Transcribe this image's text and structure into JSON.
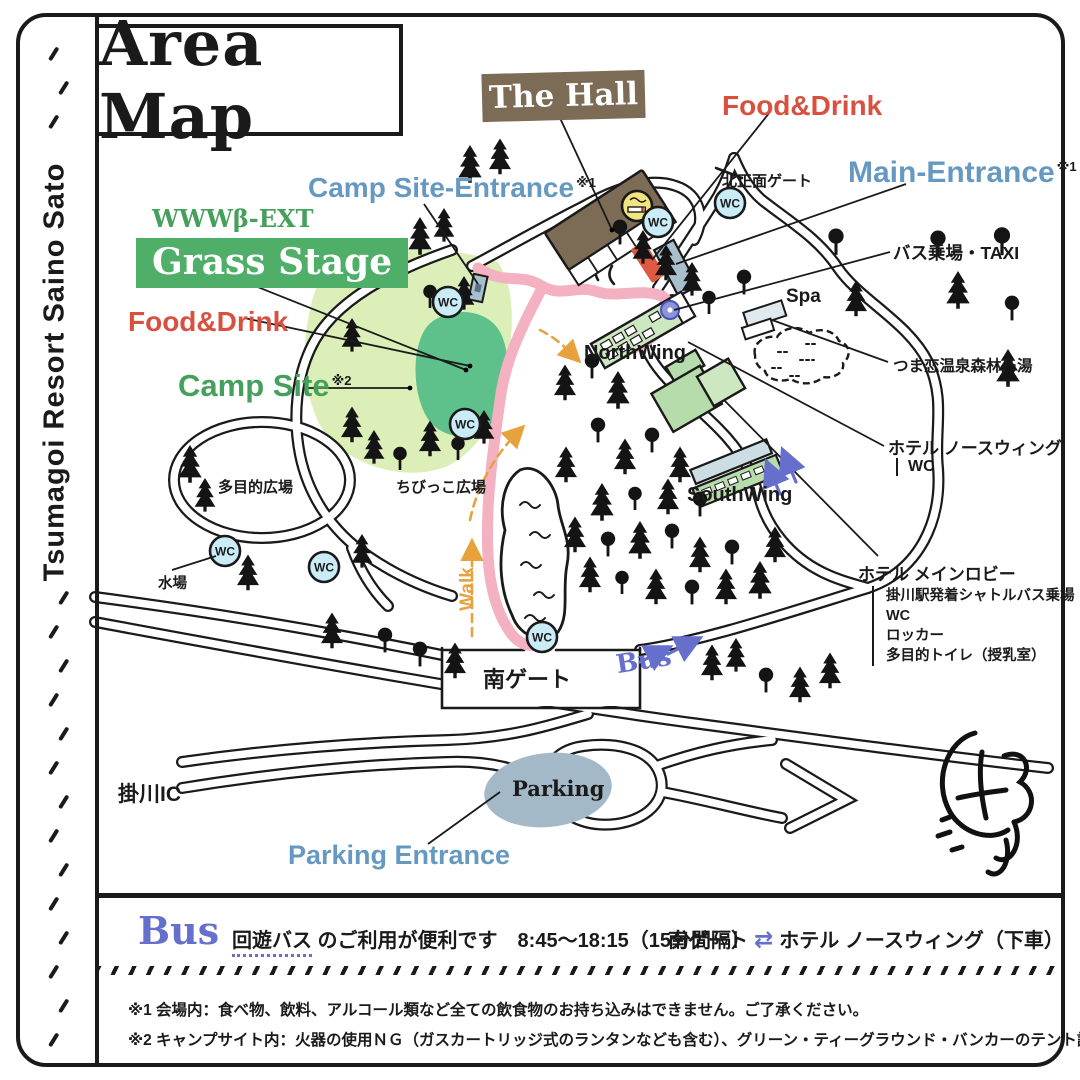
{
  "header": {
    "title": "Area Map",
    "side_label": "Tsumagoi Resort Saino Sato"
  },
  "map_labels": {
    "the_hall": "The Hall",
    "food_drink_top": "Food&Drink",
    "main_entrance": "Main-Entrance",
    "main_entrance_note": "※1",
    "north_gate": "北正面ゲート",
    "bus_taxi": "バス乗場・TAXI",
    "camp_site_entrance": "Camp Site-Entrance",
    "camp_site_entrance_note": "※1",
    "stage_brand": "WWWβ-EXT",
    "grass_stage": "Grass Stage",
    "food_drink_left": "Food&Drink",
    "camp_site": "Camp Site",
    "camp_site_note": "※2",
    "spa": "Spa",
    "onsen": "つま恋温泉森林乃湯",
    "north_wing": "NorthWing",
    "south_wing": "SouthWing",
    "hotel_north_wing": "ホテル ノースウィング",
    "hotel_north_wing_sub": "WC",
    "lobby_title": "ホテル メインロビー",
    "lobby_items": [
      "掛川駅発着シャトルバス乗場",
      "WC",
      "ロッカー",
      "多目的トイレ（授乳室）"
    ],
    "multipurpose_plaza": "多目的広場",
    "kids_plaza": "ちびっこ広場",
    "water_station": "水場",
    "south_gate": "南ゲート",
    "walk": "Walk",
    "bus": "Bus",
    "kakegawa_ic": "掛川IC",
    "parking": "Parking",
    "parking_entrance": "Parking Entrance",
    "wc": "WC"
  },
  "bus_info": {
    "heading": "Bus",
    "service": "回遊バス",
    "service_rest": " のご利用が便利です",
    "hours": "　8:45～18:15（15分間隔）",
    "route_from": "南ゲート",
    "route_arrows": "⇄",
    "route_to": "ホテル ノースウィング（下車）"
  },
  "notes": [
    "※1 会場内：食べ物、飲料、アルコール類など全ての飲食物のお持ち込みはできません。ご了承ください。",
    "※2 キャンプサイト内：火器の使用ＮＧ（ガスカートリッジ式のランタンなども含む）、グリーン・ティーグラウンド・バンカーのテント設営はできません"
  ],
  "colors": {
    "ink": "#1a1a1a",
    "red": "#d8503f",
    "blue": "#6699c2",
    "green": "#44a05a",
    "green_bg": "#4fae68",
    "light_green": "#dcefb8",
    "stage_green": "#5ec18c",
    "pink": "#f3b1c1",
    "purple": "#6670cc",
    "orange": "#e8a23d",
    "brown": "#7d6c55",
    "wc_fill": "#c9ecf7",
    "parking_fill": "#a4b9c7",
    "smoking_yellow": "#f2e47e",
    "building_green": "#b7dcab",
    "building_green2": "#cde7c0",
    "building_gray": "#a9bfce"
  }
}
